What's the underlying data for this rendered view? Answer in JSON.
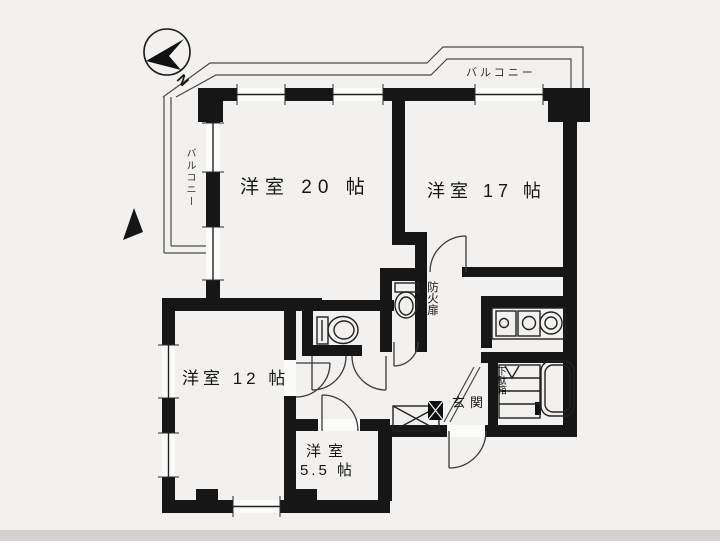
{
  "compass": {
    "north_label": "N"
  },
  "balconies": {
    "top": "バルコニー",
    "left": "バルコニー"
  },
  "rooms": {
    "western20": "洋室 20 帖",
    "western17": "洋室 17 帖",
    "western12": "洋室 12 帖",
    "western55_l1": "洋室",
    "western55_l2": "5.5 帖"
  },
  "annotations": {
    "fire_door": "防火扉",
    "entrance": "玄関",
    "shoe_cabinet": "下駄箱"
  },
  "colors": {
    "paper": "#f2f1ef",
    "wall": "#161616",
    "line": "#333333",
    "thin_line": "#4a4a4a",
    "footer_strip": "#d3d2d0"
  }
}
